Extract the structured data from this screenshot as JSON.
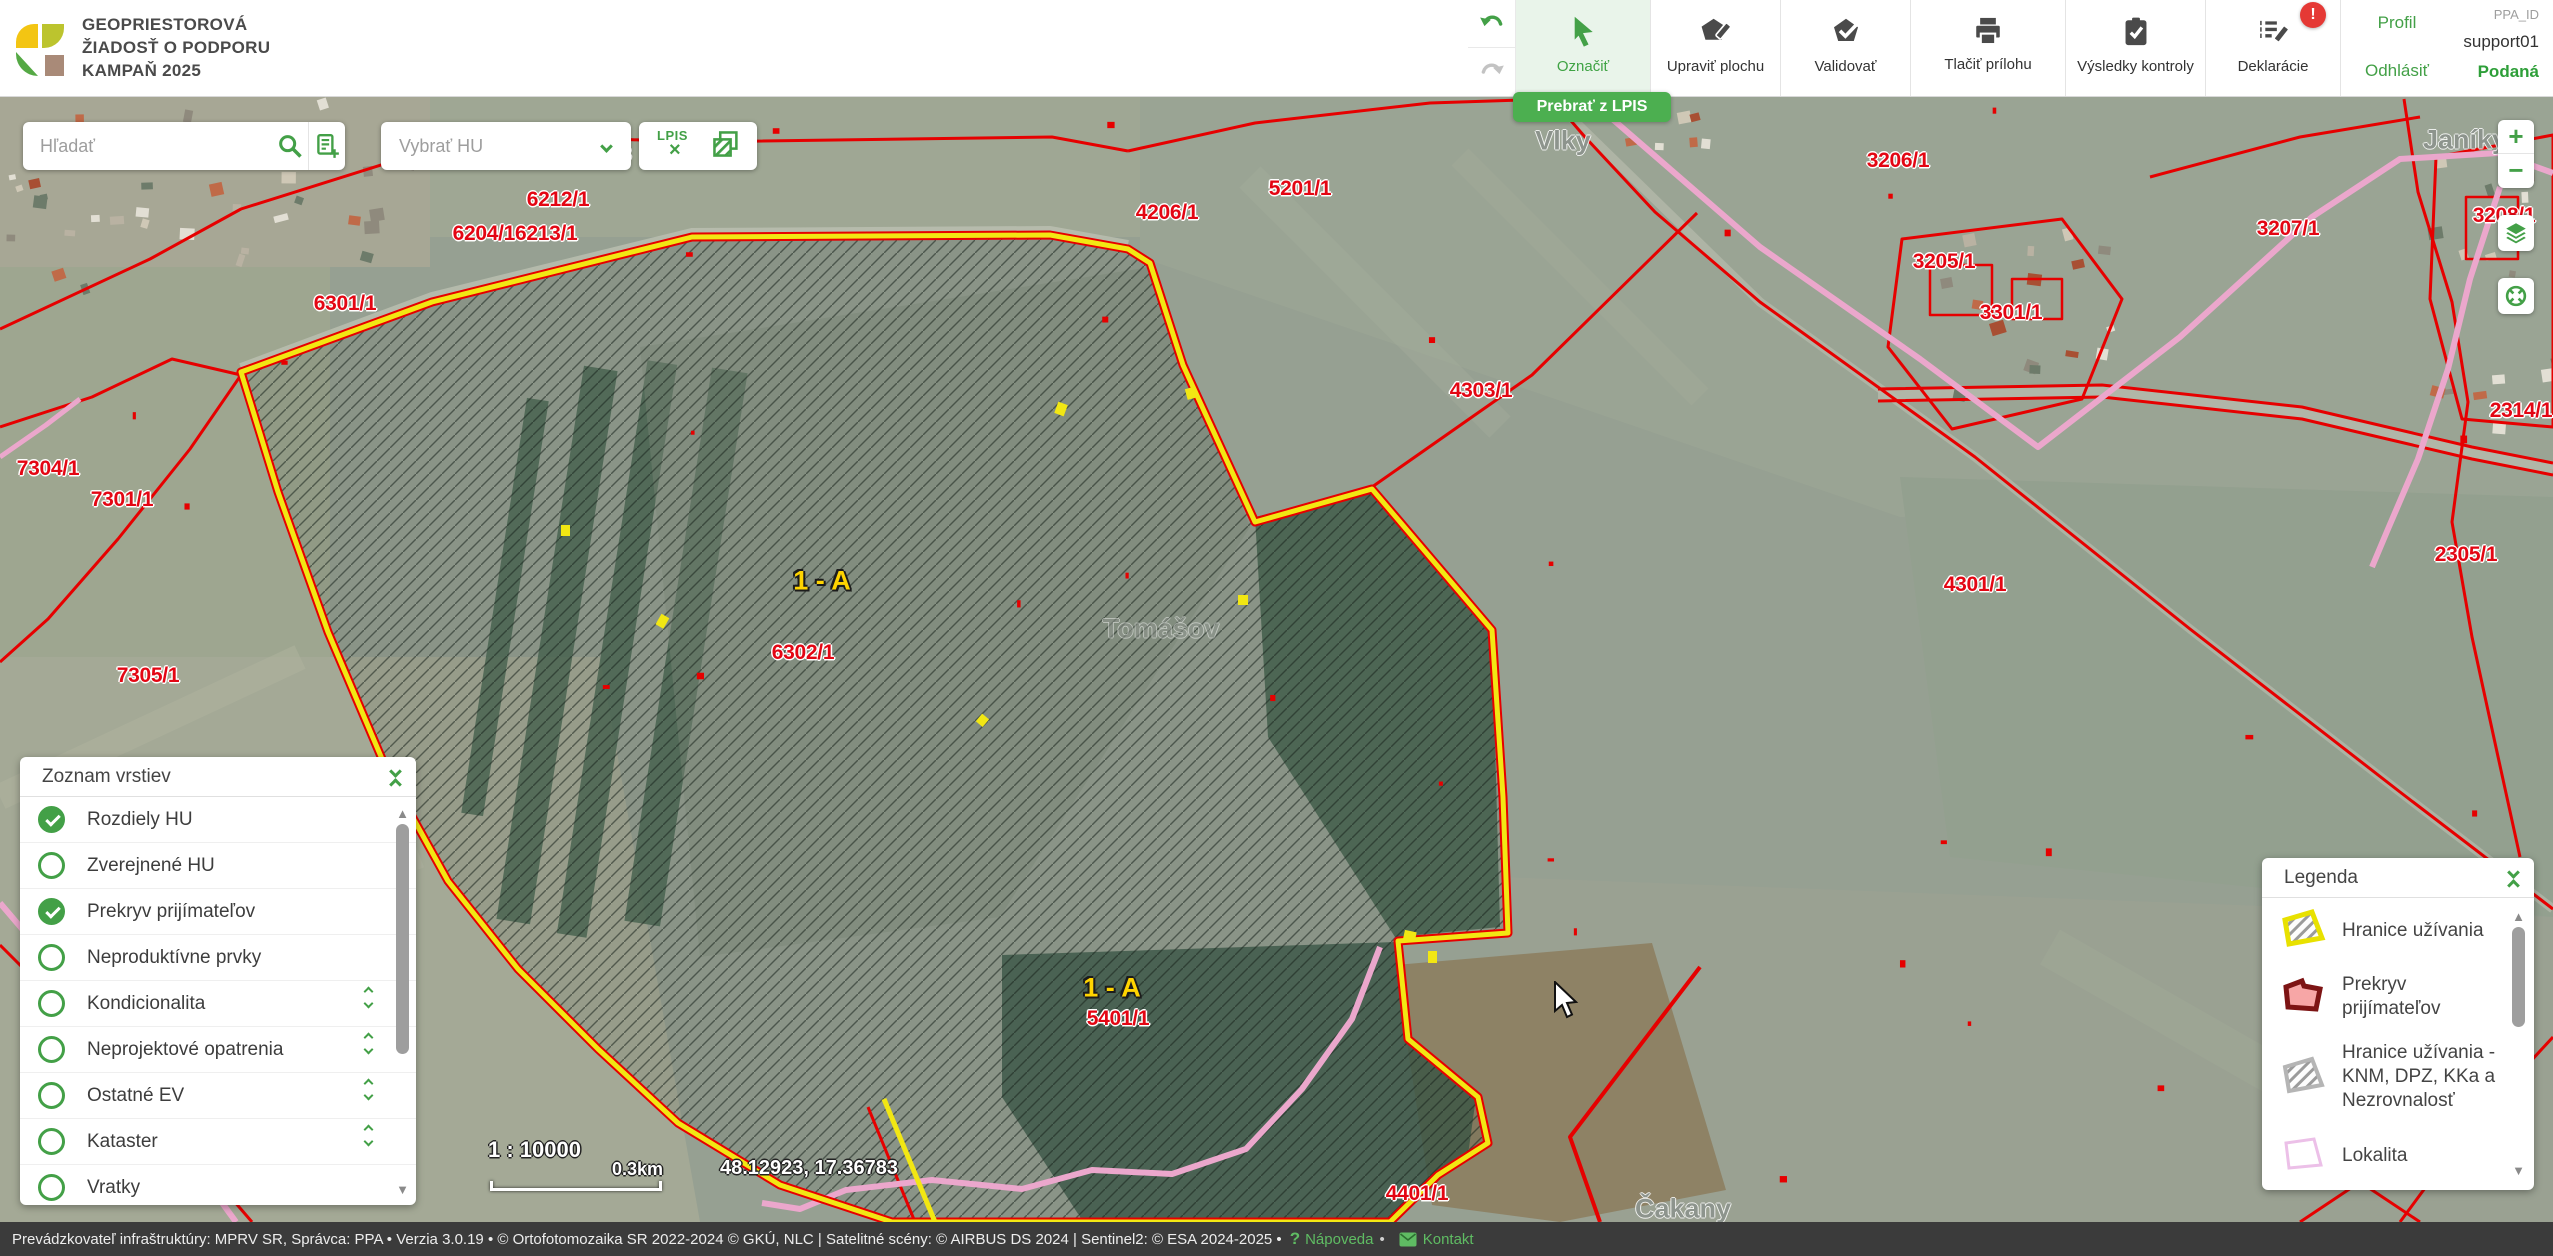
{
  "colors": {
    "accent": "#43a047",
    "badge_red": "#e53935",
    "parcel_red": "#e30613",
    "boundary_yellow": "#f2e713",
    "boundary_red": "#e60000",
    "lokalita_pink": "#eba7cc",
    "area_yellow": "#ffd400"
  },
  "header": {
    "title_lines": [
      "GEOPRIESTOROVÁ",
      "ŽIADOSŤ O PODPORU",
      "KAMPAŇ 2025"
    ],
    "toolbar": {
      "buttons": [
        {
          "id": "oznacit",
          "label": "Označiť",
          "active": true
        },
        {
          "id": "upravit-plochu",
          "label": "Upraviť plochu"
        },
        {
          "id": "validovat",
          "label": "Validovať"
        },
        {
          "id": "tlacit-prilohu",
          "label": "Tlačiť prílohu"
        },
        {
          "id": "vysledky-kontroly",
          "label": "Výsledky kontroly"
        },
        {
          "id": "deklaracie",
          "label": "Deklarácie",
          "badge": "!"
        }
      ],
      "tooltip": "Prebrať z LPIS"
    },
    "account": {
      "profil": "Profil",
      "odhlasit": "Odhlásiť",
      "ppa_label": "PPA_ID",
      "user": "support01",
      "status": "Podaná"
    }
  },
  "map": {
    "search_placeholder": "Hľadať",
    "select_placeholder": "Vybrať HU",
    "lpis_button": "LPIS",
    "zoom_in": "+",
    "zoom_out": "−",
    "scale_ratio": "1 : 10000",
    "scale_distance": "0.3km",
    "coordinates": "48.12923, 17.36783",
    "parcels": [
      {
        "text": "6212/1",
        "x": 558,
        "y": 103
      },
      {
        "text": "6204/16213/1",
        "x": 515,
        "y": 137
      },
      {
        "text": "5203/3",
        "x": 600,
        "y": 58
      },
      {
        "text": "5201/1",
        "x": 1300,
        "y": 92
      },
      {
        "text": "4206/1",
        "x": 1167,
        "y": 116
      },
      {
        "text": "6301/1",
        "x": 345,
        "y": 207
      },
      {
        "text": "7304/1",
        "x": 48,
        "y": 372
      },
      {
        "text": "7301/1",
        "x": 122,
        "y": 403
      },
      {
        "text": "7305/1",
        "x": 148,
        "y": 579
      },
      {
        "text": "6302/1",
        "x": 803,
        "y": 556
      },
      {
        "text": "5401/1",
        "x": 1118,
        "y": 922
      },
      {
        "text": "4401/1",
        "x": 1417,
        "y": 1097
      },
      {
        "text": "4303/1",
        "x": 1481,
        "y": 294
      },
      {
        "text": "4301/1",
        "x": 1975,
        "y": 488
      },
      {
        "text": "2305/1",
        "x": 2466,
        "y": 458
      },
      {
        "text": "2314/1",
        "x": 2521,
        "y": 314
      },
      {
        "text": "3206/1",
        "x": 1898,
        "y": 64
      },
      {
        "text": "3205/1",
        "x": 1944,
        "y": 165
      },
      {
        "text": "3301/1",
        "x": 2011,
        "y": 216
      },
      {
        "text": "3207/1",
        "x": 2288,
        "y": 132
      },
      {
        "text": "3208/1",
        "x": 2504,
        "y": 119
      }
    ],
    "areas": [
      {
        "text": "1 - A",
        "x": 822,
        "y": 484
      },
      {
        "text": "1 - A",
        "x": 1112,
        "y": 891
      }
    ],
    "places": [
      {
        "text": "Vlky",
        "x": 1563,
        "y": 44,
        "dim": false
      },
      {
        "text": "Janíky",
        "x": 2465,
        "y": 43,
        "dim": false
      },
      {
        "text": "Tomášov",
        "x": 1161,
        "y": 532,
        "dim": true
      },
      {
        "text": "Čakany",
        "x": 1683,
        "y": 1112,
        "dim": false
      }
    ],
    "layers_panel": {
      "title": "Zoznam vrstiev",
      "items": [
        {
          "label": "Rozdiely HU",
          "checked": true,
          "expandable": false
        },
        {
          "label": "Zverejnené HU",
          "checked": false,
          "expandable": false
        },
        {
          "label": "Prekryv prijímateľov",
          "checked": true,
          "expandable": false
        },
        {
          "label": "Neproduktívne prvky",
          "checked": false,
          "expandable": false
        },
        {
          "label": "Kondicionalita",
          "checked": false,
          "expandable": true
        },
        {
          "label": "Neprojektové opatrenia",
          "checked": false,
          "expandable": true
        },
        {
          "label": "Ostatné EV",
          "checked": false,
          "expandable": true
        },
        {
          "label": "Kataster",
          "checked": false,
          "expandable": true
        },
        {
          "label": "Vratky",
          "checked": false,
          "expandable": false
        }
      ]
    },
    "legend_panel": {
      "title": "Legenda",
      "items": [
        {
          "label": "Hranice užívania",
          "swatch": "yellow-hatch"
        },
        {
          "label": "Prekryv prijímateľov",
          "swatch": "red-pink"
        },
        {
          "label": "Hranice užívania - KNM, DPZ, KKa a Nezrovnalosť",
          "swatch": "gray-hatch"
        },
        {
          "label": "Lokalita",
          "swatch": "pink-outline"
        }
      ]
    },
    "measure_panel": {
      "title": "Meranie",
      "tools": [
        "measure-distance-icon",
        "measure-area-icon",
        "measure-area-partial-icon"
      ]
    }
  },
  "footer": {
    "text": "Prevádzkovateľ infraštruktúry: MPRV SR, Správca: PPA • Verzia 3.0.19 • © Ortofotomozaika SR 2022-2024 © GKÚ, NLC | Satelitné scény: © AIRBUS DS 2024 | Sentinel2: © ESA 2024-2025 •",
    "help": "Nápoveda",
    "contact": "Kontakt"
  }
}
